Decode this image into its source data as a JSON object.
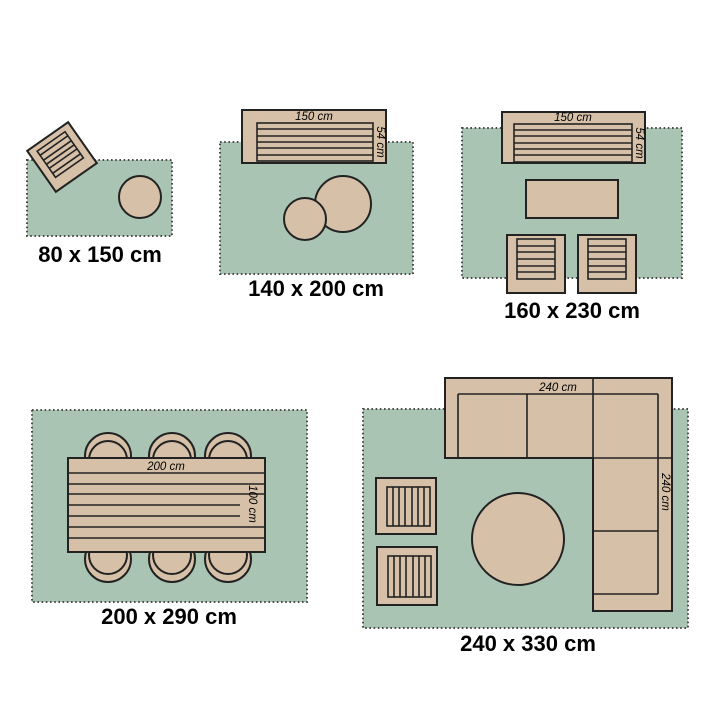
{
  "colors": {
    "background": "#ffffff",
    "rug_fill": "#a9c4b3",
    "furniture_fill": "#d6c1a8",
    "outline": "#222222",
    "rug_dot": "#4a4a4a",
    "text": "#000000"
  },
  "diagrams": [
    {
      "name": "rug-80x150",
      "size_label": "80 x 150 cm"
    },
    {
      "name": "rug-140x200",
      "size_label": "140 x 200 cm",
      "sofa": {
        "width_label": "150 cm",
        "depth_label": "54 cm"
      }
    },
    {
      "name": "rug-160x230",
      "size_label": "160 x 230 cm",
      "sofa": {
        "width_label": "150 cm",
        "depth_label": "54 cm"
      }
    },
    {
      "name": "rug-200x290",
      "size_label": "200 x 290 cm",
      "table": {
        "width_label": "200 cm",
        "depth_label": "100 cm"
      }
    },
    {
      "name": "rug-240x330",
      "size_label": "240 x 330 cm",
      "sofa": {
        "width_label": "240 cm",
        "depth_label": "240 cm"
      }
    }
  ]
}
